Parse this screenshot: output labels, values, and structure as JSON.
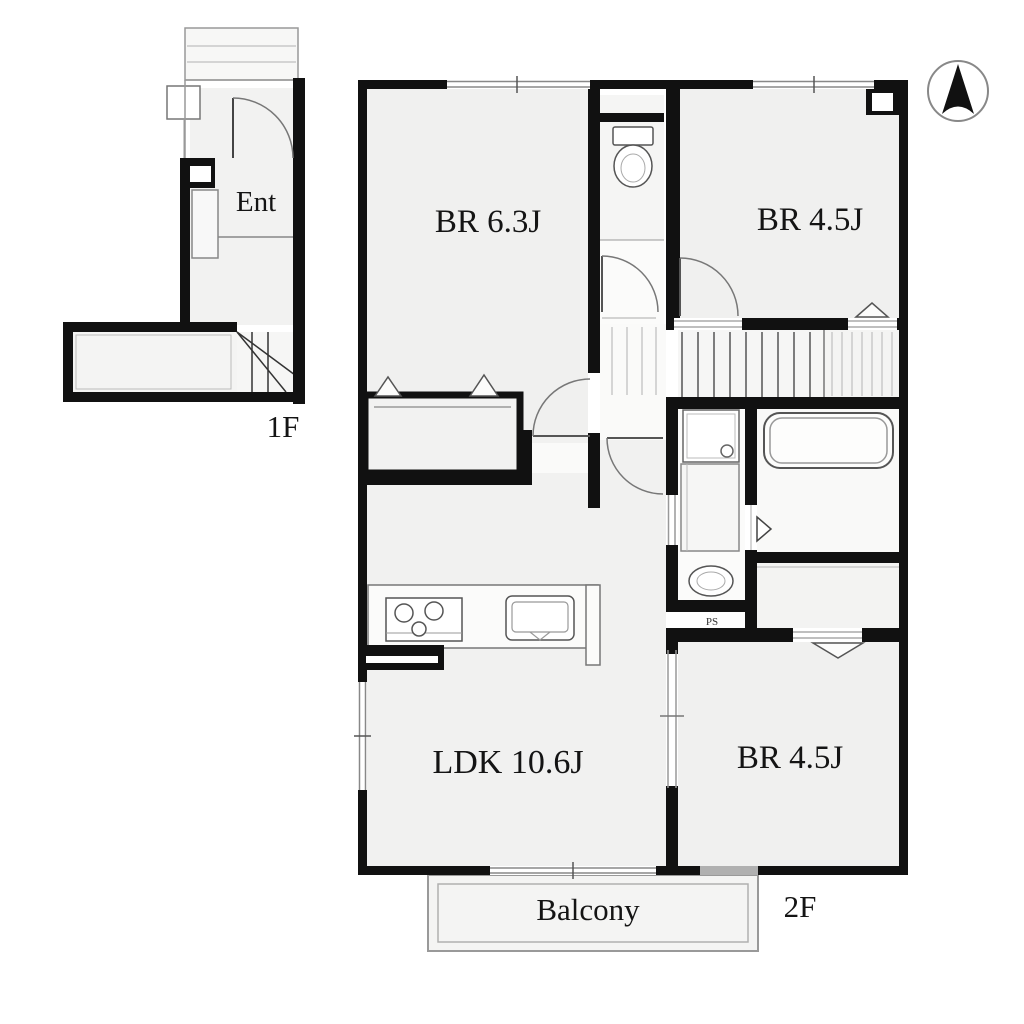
{
  "plan": {
    "compass": "north-arrow",
    "floors": [
      {
        "id": "1F",
        "label": "1F",
        "rooms": [
          {
            "label": "Ent"
          }
        ]
      },
      {
        "id": "2F",
        "label": "2F",
        "rooms": [
          {
            "label": "BR 6.3J"
          },
          {
            "label": "BR 4.5J"
          },
          {
            "label": "LDK 10.6J"
          },
          {
            "label": "BR 4.5J"
          },
          {
            "label": "Balcony"
          },
          {
            "label": "PS"
          }
        ]
      }
    ],
    "colors": {
      "wall": "#111111",
      "room_fill": "#f0f0ef",
      "fixture_line": "#555555",
      "thin_line": "#999999",
      "window_gray": "#b0b0b0"
    }
  }
}
